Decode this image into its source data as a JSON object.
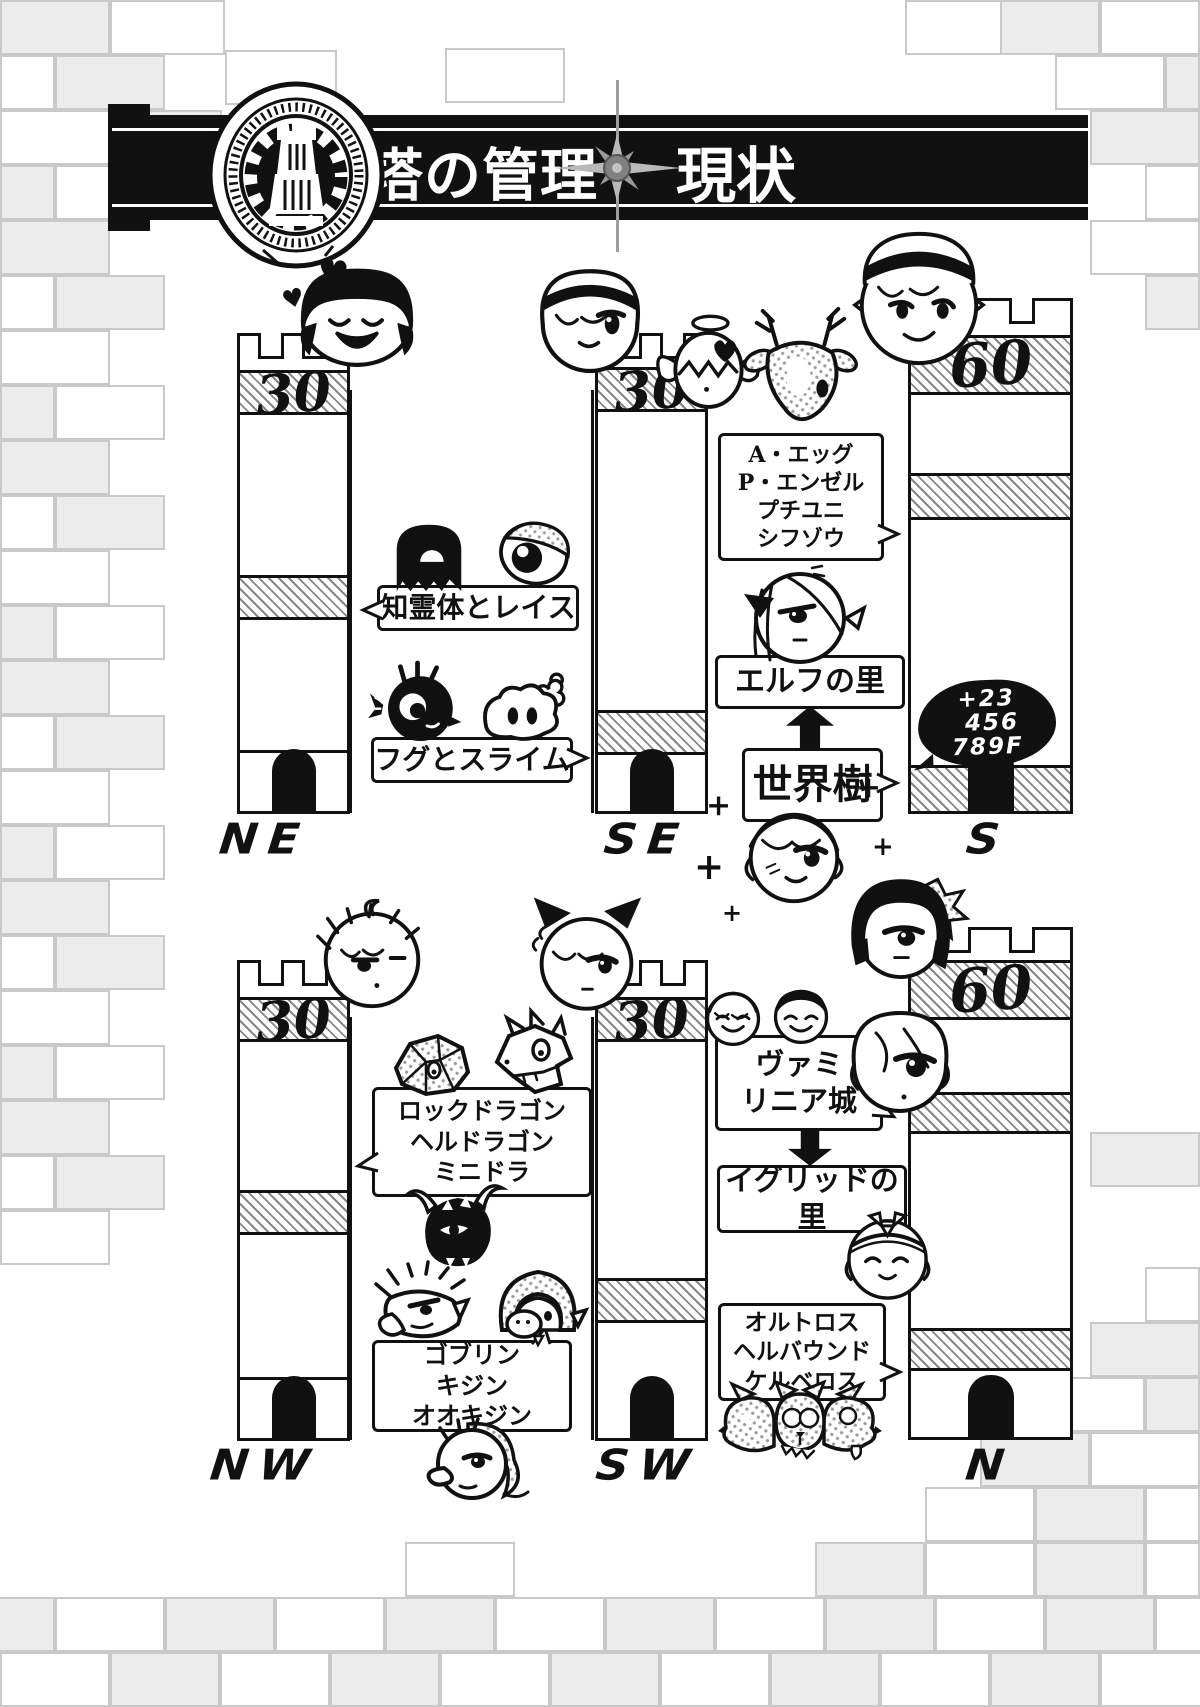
{
  "banner": {
    "title_left": "塔の管理",
    "title_right": "現状MAP"
  },
  "towers": {
    "ne": {
      "floor": "30",
      "dir": "NE"
    },
    "se": {
      "floor": "30",
      "dir": "SE"
    },
    "s": {
      "floor": "60",
      "dir": "S"
    },
    "nw": {
      "floor": "30",
      "dir": "NW"
    },
    "sw": {
      "floor": "30",
      "dir": "SW"
    },
    "n": {
      "floor": "60",
      "dir": "N"
    }
  },
  "labels": {
    "spirits": "知霊体とレイス",
    "fugu_slime": "フグとスライム",
    "angel_group": [
      "A・エッグ",
      "P・エンゼル",
      "プチユニ",
      "シフゾウ"
    ],
    "elf_village": "エルフの里",
    "world_tree": "世界樹",
    "s_floors_added": [
      "+23",
      "456",
      "789F"
    ],
    "dragon_group": [
      "ロックドラゴン",
      "ヘルドラゴン",
      "ミニドラ"
    ],
    "goblin_group": [
      "ゴブリン",
      "キジン",
      "オオキジン"
    ],
    "vamirinia_castle": [
      "ヴァミ",
      "リニア城"
    ],
    "igrid_village": "イグリッドの里",
    "hound_group": [
      "オルトロス",
      "ヘルバウンド",
      "ケルベロス"
    ]
  },
  "decor": {
    "heart": "♥",
    "sparkle": "+"
  }
}
